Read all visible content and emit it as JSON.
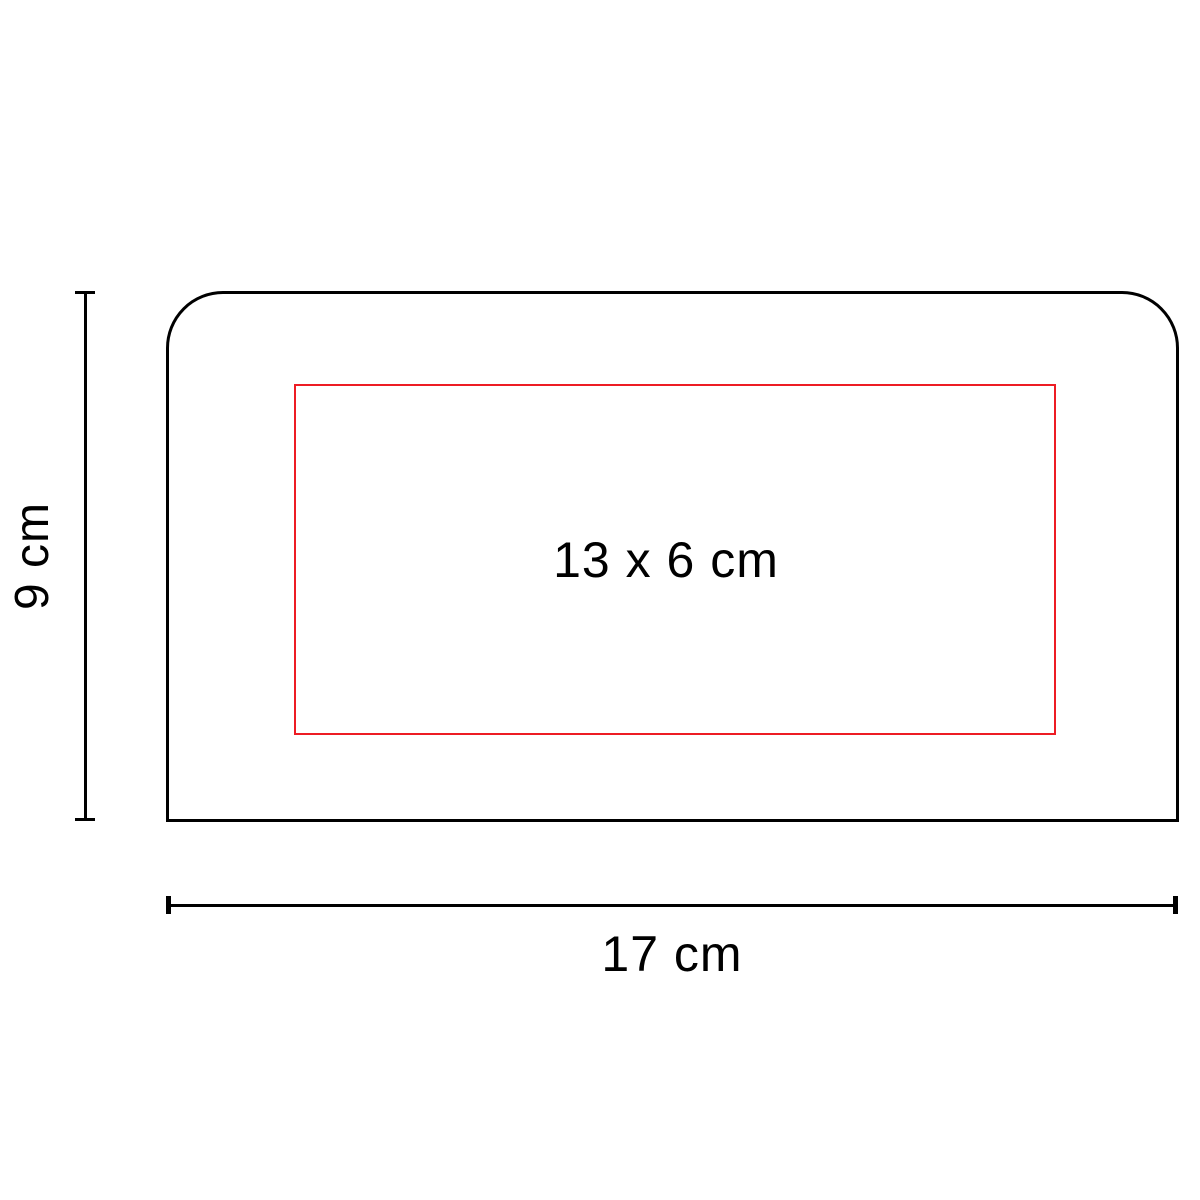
{
  "diagram": {
    "kind": "product-print-area-dimension-diagram",
    "product_outline": {
      "shape": "rectangle-rounded-top-corners"
    },
    "print_area": {
      "label": "13 x 6 cm"
    },
    "dimensions": {
      "height": {
        "label": "9 cm"
      },
      "width": {
        "label": "17 cm"
      }
    }
  },
  "colors": {
    "outline": "#000000",
    "dimension-line": "#000000",
    "print-area": "#ed1c24",
    "label-text": "#000000",
    "background": "#ffffff"
  }
}
